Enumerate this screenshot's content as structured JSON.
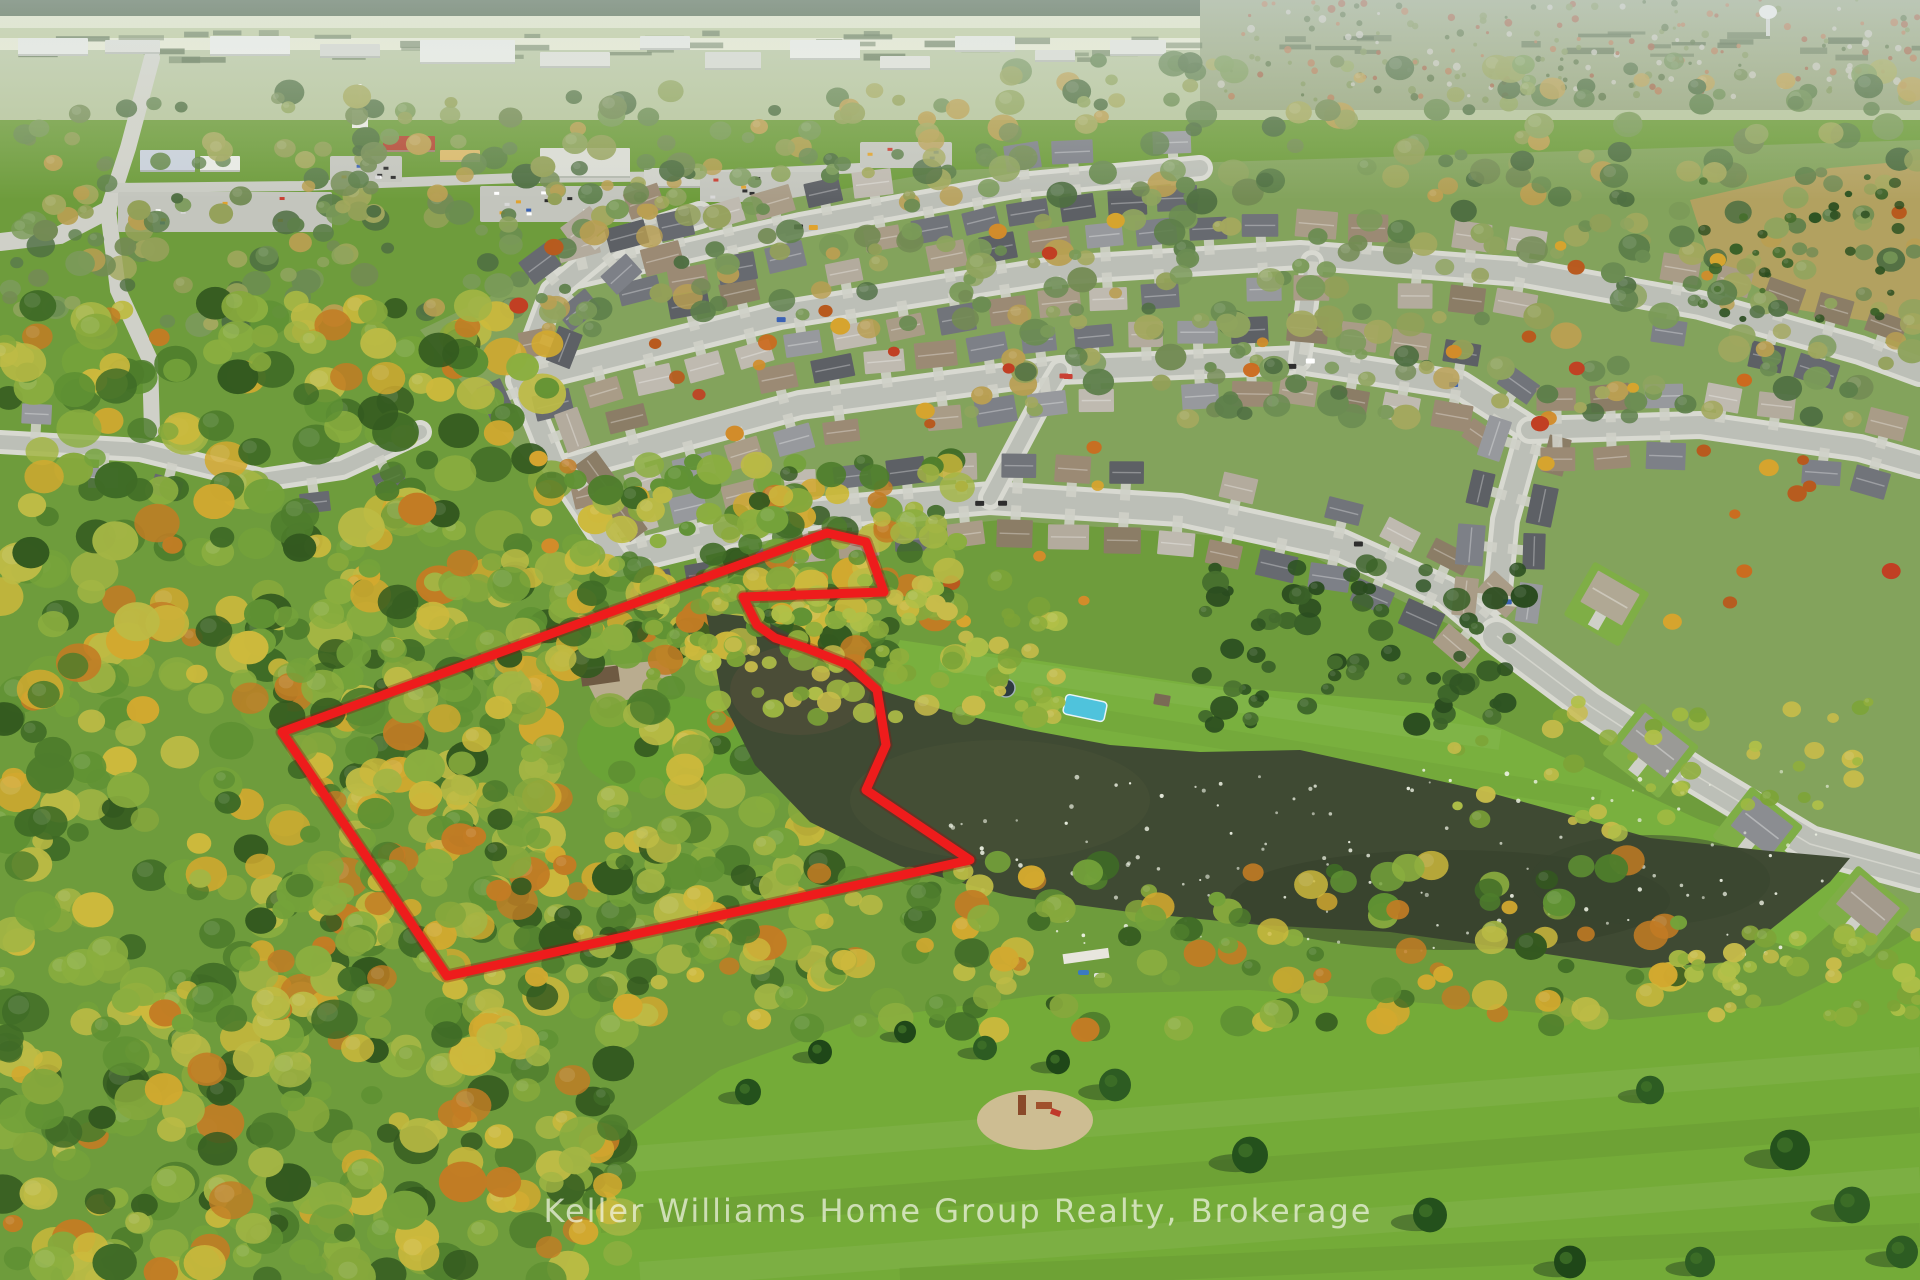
{
  "image": {
    "kind": "aerial-drone-photo",
    "width": 1920,
    "height": 1280,
    "subject": "autumn aerial view of a suburban neighbourhood with a pond, forested land parcel outlined in red, and a park field"
  },
  "watermark": {
    "text": "Keller Williams Home Group Realty, Brokerage",
    "x": 958,
    "y": 1222,
    "font_size": 32,
    "letter_spacing": 2,
    "color": "rgba(242,245,230,0.72)"
  },
  "property_outline": {
    "color": "#ee1c1c",
    "halo_color": "#8e0f0f",
    "stroke_width": 9,
    "points": "827,533 866,542 884,592 743,597 757,625 775,638 806,648 849,665 877,690 886,745 866,790 970,860 447,976 282,732"
  },
  "pond": {
    "fill": "#3f4a33",
    "points": "706,612 760,618 820,650 880,690 950,712 1030,730 1110,745 1200,752 1300,750 1400,772 1480,790 1560,812 1650,838 1760,850 1850,858 1830,882 1730,962 1640,968 1520,950 1390,932 1260,925 1130,912 1010,896 900,866 810,822 755,765 722,700",
    "patches": [
      {
        "cx": 800,
        "cy": 690,
        "rx": 70,
        "ry": 45,
        "fill": "#55503a",
        "opacity": 0.55
      },
      {
        "cx": 1000,
        "cy": 800,
        "rx": 150,
        "ry": 60,
        "fill": "#4c5438",
        "opacity": 0.45
      },
      {
        "cx": 1450,
        "cy": 900,
        "rx": 220,
        "ry": 50,
        "fill": "#343e2a",
        "opacity": 0.5
      },
      {
        "cx": 1650,
        "cy": 880,
        "rx": 120,
        "ry": 45,
        "fill": "#38432d",
        "opacity": 0.5
      }
    ],
    "birds": {
      "region": [
        950,
        770,
        880,
        185
      ],
      "count": 130,
      "color": "#eef2e4"
    }
  },
  "palettes": {
    "vivid": [
      "#3f6b26",
      "#4e7d2c",
      "#5f9133",
      "#74a23a",
      "#8bae3f",
      "#a3b544",
      "#bdbb45",
      "#cdb93c",
      "#d2a92f",
      "#c27c24",
      "#33591f",
      "#86a83c"
    ],
    "muted": [
      "#5d7f4a",
      "#6b8c52",
      "#7a9a58",
      "#8fa45e",
      "#a3a85e",
      "#738b54",
      "#4f6f42",
      "#b99f52",
      "#93a058"
    ],
    "dark": [
      "#2e5322",
      "#3a6128",
      "#476f2e",
      "#2a4c1f"
    ],
    "shore": [
      "#8fae3c",
      "#9fb942",
      "#b0c048",
      "#7da437",
      "#c8bc4a"
    ],
    "accent": [
      "#d28c2a",
      "#c13f23",
      "#d6a42e",
      "#b85a1e",
      "#cc6a1e"
    ],
    "roofs": [
      "#97999d",
      "#71747a",
      "#a99c87",
      "#8b7d66",
      "#bfbab0",
      "#676a70",
      "#9b8a74",
      "#b3ab9d",
      "#7d8087",
      "#5d6065"
    ],
    "cars": [
      "#c94034",
      "#3b62b5",
      "#d8d8d8",
      "#2e2e2e",
      "#e0a32e",
      "#ffffff"
    ]
  },
  "scene": {
    "base_color": "#6e9c3c",
    "top_strips": [
      {
        "rect": [
          0,
          0,
          1920,
          16
        ],
        "fill": "#42593a"
      },
      {
        "rect": [
          0,
          16,
          1920,
          12
        ],
        "fill": "#dfe3c2"
      },
      {
        "rect": [
          0,
          28,
          1920,
          10
        ],
        "fill": "#b9c795"
      },
      {
        "rect": [
          0,
          38,
          1920,
          12
        ],
        "fill": "#e6e9cf"
      },
      {
        "rect": [
          0,
          50,
          1920,
          70
        ],
        "fill": "#b5c49c"
      },
      {
        "rect": [
          1200,
          0,
          720,
          110
        ],
        "fill": "#97a67f"
      }
    ],
    "panels": [
      {
        "name": "subdivision-ground",
        "points": "420,330 640,225 950,170 1350,158 1920,140 1920,940 1700,800 1500,650 1280,540 1000,520 760,545 620,565 500,430",
        "fill": "#83a35c"
      },
      {
        "name": "north-field",
        "points": "900,640 1200,685 1450,705 1700,820 1880,880 1800,950 1500,860 1250,800 1000,740 880,690",
        "fill": "#79b03e"
      },
      {
        "name": "park-field",
        "points": "560,1280 620,1140 720,1070 860,1020 1040,995 1250,990 1450,1005 1620,1020 1780,1005 1870,960 1920,930 1920,1280",
        "fill": "#74ab38"
      },
      {
        "name": "meadow",
        "points": "1690,200 1830,168 1920,160 1920,330 1800,310 1710,262",
        "fill": "#b2a160"
      }
    ],
    "mow_stripes": [
      {
        "pts": "620,1160 1920,1060",
        "w": 26,
        "color": "#ffffff",
        "op": 0.06
      },
      {
        "pts": "600,1220 1920,1120",
        "w": 26,
        "color": "#000000",
        "op": 0.05
      },
      {
        "pts": "640,1275 1920,1180",
        "w": 26,
        "color": "#ffffff",
        "op": 0.06
      },
      {
        "pts": "900,1280 1920,1235",
        "w": 24,
        "color": "#000000",
        "op": 0.05
      },
      {
        "pts": "940,660 1500,740",
        "w": 20,
        "color": "#ffffff",
        "op": 0.05
      },
      {
        "pts": "980,700 1600,800",
        "w": 20,
        "color": "#000000",
        "op": 0.04
      }
    ],
    "commercial_roads": [
      {
        "pts": "152,58 128,148 108,210 118,290 150,360 152,430",
        "w": 16,
        "color": "#cfd0c8"
      },
      {
        "pts": "108,210 60,235 0,242",
        "w": 18,
        "color": "#cfd0c8"
      },
      {
        "pts": "110,188 300,186 520,178 700,176 860,168",
        "w": 10,
        "color": "#c9cbc3"
      }
    ],
    "parking_lots": [
      [
        118,
        192,
        214,
        40
      ],
      [
        330,
        156,
        72,
        26
      ],
      [
        480,
        186,
        162,
        36
      ],
      [
        700,
        172,
        122,
        30
      ],
      [
        860,
        142,
        92,
        26
      ],
      [
        940,
        172,
        112,
        30
      ]
    ],
    "commercial_buildings": [
      [
        18,
        38,
        70,
        18,
        "#e6e8e2"
      ],
      [
        105,
        40,
        55,
        14,
        "#dadcd4"
      ],
      [
        210,
        36,
        80,
        20,
        "#eceee8"
      ],
      [
        320,
        44,
        60,
        14,
        "#d2d4cc"
      ],
      [
        420,
        40,
        95,
        24,
        "#e9ebe5"
      ],
      [
        540,
        52,
        70,
        16,
        "#dddfd7"
      ],
      [
        640,
        36,
        50,
        14,
        "#e4e6e0"
      ],
      [
        705,
        52,
        56,
        18,
        "#d5d7cf"
      ],
      [
        790,
        40,
        70,
        20,
        "#eaece6"
      ],
      [
        880,
        56,
        50,
        14,
        "#dfe1d9"
      ],
      [
        955,
        36,
        60,
        16,
        "#e6e8e0"
      ],
      [
        1035,
        50,
        40,
        12,
        "#d8dad2"
      ],
      [
        1110,
        40,
        56,
        16,
        "#e2e4dc"
      ],
      [
        140,
        150,
        55,
        22,
        "#c8d0da"
      ],
      [
        200,
        156,
        40,
        16,
        "#e8eae4"
      ],
      [
        383,
        136,
        52,
        16,
        "#b34a36"
      ],
      [
        440,
        150,
        40,
        12,
        "#d9b96a"
      ],
      [
        540,
        148,
        90,
        30,
        "#d9dbd3"
      ],
      [
        644,
        168,
        56,
        20,
        "#cfd1c9"
      ]
    ],
    "parking_cars": {
      "count": 46
    },
    "streets": [
      {
        "pts": "618,560 800,515 990,498 1180,510 1340,545 1445,592 1497,636",
        "w": 24,
        "houses": {
          "spacing": 54,
          "offset": 34,
          "skip": 0.12
        }
      },
      {
        "pts": "560,470 800,405 1060,370 1300,360 1460,385 1530,430 1505,520 1497,600",
        "w": 20,
        "houses": {
          "spacing": 52,
          "offset": 32,
          "skip": 0.15
        }
      },
      {
        "pts": "520,380 780,315 1060,270 1300,255 1520,272 1700,305 1860,350 1920,372",
        "w": 20,
        "houses": {
          "spacing": 52,
          "offset": 32,
          "skip": 0.15
        }
      },
      {
        "pts": "560,280 800,225 1020,185 1200,168",
        "w": 16,
        "houses": {
          "spacing": 50,
          "offset": 28,
          "skip": 0.2
        }
      },
      {
        "pts": "618,560 553,462 520,380 553,292 612,243 700,215",
        "w": 18,
        "houses": {
          "spacing": 56,
          "offset": 30,
          "skip": 0.3
        }
      },
      {
        "pts": "1530,430 1700,425 1860,448 1920,465",
        "w": 18,
        "houses": {
          "spacing": 54,
          "offset": 30,
          "skip": 0.2
        }
      },
      {
        "pts": "990,498 1042,400 1060,370",
        "w": 14,
        "houses": null
      },
      {
        "pts": "1300,360 1312,262",
        "w": 14,
        "houses": null
      },
      {
        "pts": "0,442 140,450 262,480 342,468 420,432",
        "w": 14,
        "houses": {
          "spacing": 70,
          "offset": 30,
          "skip": 0.35
        },
        "old": true
      }
    ],
    "main_road": {
      "pts": "1497,636 1590,706 1700,778 1810,844 1920,874",
      "w": 28
    },
    "se_houses": [
      {
        "x": 1655,
        "y": 745,
        "w": 56,
        "h": 40,
        "rot": 38,
        "roof": "#9a9a96"
      },
      {
        "x": 1762,
        "y": 826,
        "w": 50,
        "h": 38,
        "rot": 38,
        "roof": "#8b8d91"
      },
      {
        "x": 1868,
        "y": 906,
        "w": 52,
        "h": 38,
        "rot": 40,
        "roof": "#a39a8c"
      },
      {
        "x": 1610,
        "y": 598,
        "w": 48,
        "h": 36,
        "rot": 30,
        "roof": "#b0a894"
      }
    ],
    "backyard_objects": [
      {
        "type": "pool",
        "x": 1085,
        "y": 708,
        "w": 42,
        "h": 20,
        "rot": 12,
        "fill": "#4fc3dc"
      },
      {
        "type": "trampoline",
        "x": 1006,
        "y": 688,
        "r": 9,
        "fill": "#2e3b40"
      },
      {
        "type": "shed",
        "x": 1162,
        "y": 700,
        "w": 16,
        "h": 11,
        "rot": 10,
        "fill": "#7a6a55"
      }
    ],
    "clearing": {
      "gravel": "580,668 665,660 682,700 600,708",
      "gravel_fill": "#b9ac8f",
      "cabin": {
        "x": 600,
        "y": 676,
        "w": 38,
        "h": 16,
        "rot": -8,
        "fill": "#6e5a42"
      },
      "lawn": {
        "cx": 665,
        "cy": 745,
        "rx": 88,
        "ry": 50,
        "fill": "#6aa336"
      }
    },
    "tree_regions": [
      {
        "rect": [
          0,
          90,
          960,
          240
        ],
        "count": 260,
        "palette": "muted",
        "rmin": 6,
        "rmax": 15
      },
      {
        "rect": [
          960,
          60,
          960,
          360
        ],
        "count": 330,
        "palette": "muted",
        "rmin": 6,
        "rmax": 16
      },
      {
        "rect": [
          0,
          300,
          560,
          760
        ],
        "count": 430,
        "palette": "vivid",
        "rmin": 10,
        "rmax": 24
      },
      {
        "rect": [
          280,
          560,
          580,
          420
        ],
        "count": 300,
        "palette": "vivid",
        "rmin": 10,
        "rmax": 22
      },
      {
        "rect": [
          0,
          1000,
          620,
          280
        ],
        "count": 220,
        "palette": "vivid",
        "rmin": 10,
        "rmax": 24
      },
      {
        "rect": [
          1200,
          560,
          330,
          170
        ],
        "count": 70,
        "palette": "dark",
        "rmin": 6,
        "rmax": 14
      },
      {
        "rect": [
          500,
          200,
          1400,
          430
        ],
        "count": 55,
        "palette": "accent",
        "rmin": 5,
        "rmax": 10,
        "sparse": true
      }
    ],
    "post_pond_tree_regions": [
      {
        "rect": [
          560,
          460,
          400,
          200
        ],
        "count": 170,
        "palette": "vivid",
        "rmin": 8,
        "rmax": 18
      },
      {
        "rect": [
          640,
          580,
          420,
          140
        ],
        "count": 90,
        "palette": "shore",
        "rmin": 6,
        "rmax": 13
      },
      {
        "rect": [
          1450,
          700,
          420,
          150
        ],
        "count": 45,
        "palette": "shore",
        "rmin": 5,
        "rmax": 11
      },
      {
        "rect": [
          600,
          860,
          1080,
          170
        ],
        "count": 170,
        "palette": "vivid",
        "rmin": 8,
        "rmax": 18
      },
      {
        "rect": [
          1680,
          930,
          240,
          90
        ],
        "count": 40,
        "palette": "shore",
        "rmin": 6,
        "rmax": 12
      }
    ],
    "shrubs_meadow": {
      "rect": [
        1700,
        175,
        210,
        145
      ],
      "count": 34,
      "palette": "dark",
      "rmin": 3,
      "rmax": 7
    },
    "conifers": [
      [
        1115,
        1085,
        16
      ],
      [
        1250,
        1155,
        18
      ],
      [
        1430,
        1215,
        17
      ],
      [
        1570,
        1262,
        16
      ],
      [
        1790,
        1150,
        20
      ],
      [
        1852,
        1205,
        18
      ],
      [
        1902,
        1252,
        16
      ],
      [
        1700,
        1262,
        15
      ],
      [
        985,
        1048,
        12
      ],
      [
        1058,
        1062,
        12
      ],
      [
        905,
        1032,
        11
      ],
      [
        820,
        1052,
        12
      ],
      [
        748,
        1092,
        13
      ],
      [
        1650,
        1090,
        14
      ]
    ],
    "playground": {
      "sand": {
        "cx": 1035,
        "cy": 1120,
        "rx": 58,
        "ry": 30,
        "fill": "#cdbd92"
      },
      "parts": [
        {
          "x": 1018,
          "y": 1095,
          "w": 8,
          "h": 20,
          "fill": "#8a4a2a",
          "rot": 0
        },
        {
          "x": 1036,
          "y": 1102,
          "w": 16,
          "h": 7,
          "fill": "#a0522d",
          "rot": 0
        },
        {
          "x": 1052,
          "y": 1108,
          "w": 10,
          "h": 6,
          "fill": "#c0392b",
          "rot": 20
        }
      ]
    },
    "dock": {
      "x": 1086,
      "y": 956,
      "w": 46,
      "h": 10,
      "rot": -8,
      "fill": "#e8e6de",
      "boats": [
        {
          "x": 1078,
          "y": 970,
          "w": 11,
          "h": 5,
          "fill": "#3a7ac0"
        },
        {
          "x": 1094,
          "y": 973,
          "w": 11,
          "h": 5,
          "fill": "#e2e2e0"
        }
      ]
    },
    "landmarks": {
      "water_tower": {
        "x": 1768,
        "y": 12
      },
      "church": {
        "x": 360,
        "y": 118
      }
    },
    "street_cars": {
      "count": 14
    }
  }
}
